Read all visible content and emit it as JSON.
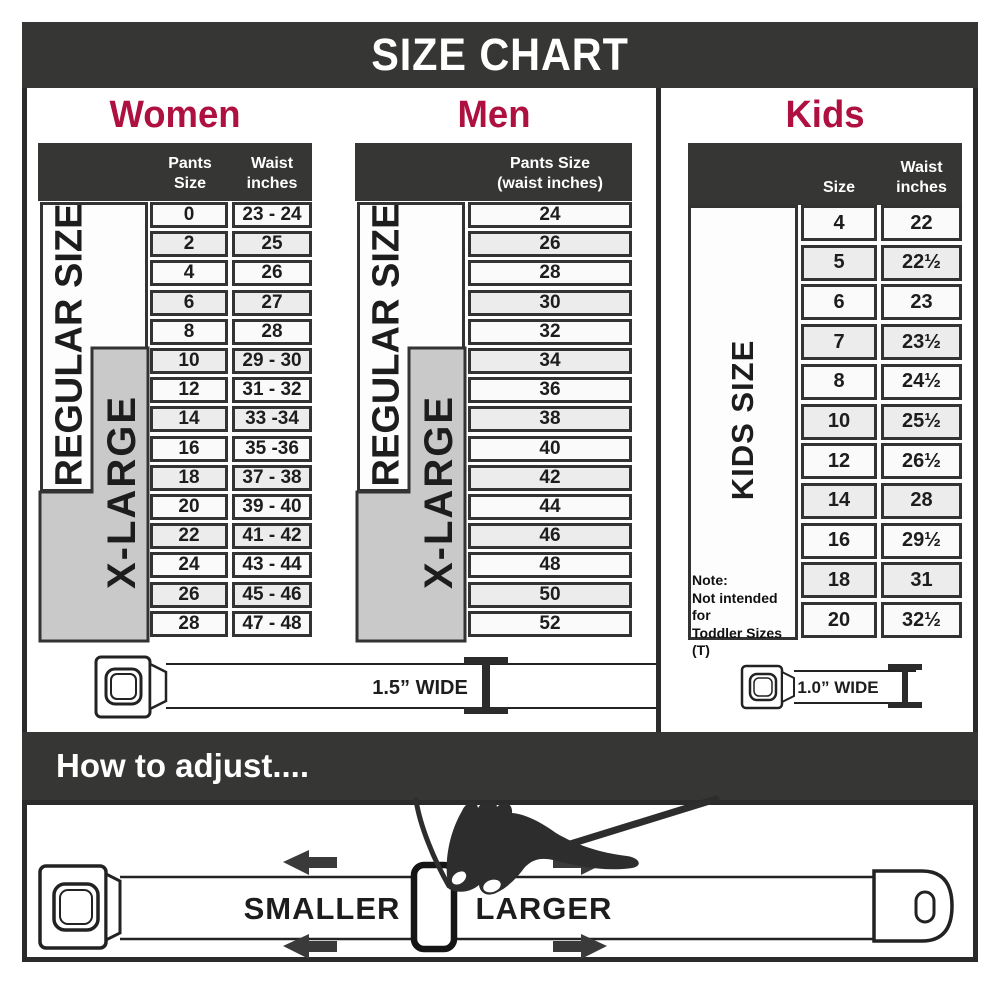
{
  "title": "SIZE CHART",
  "colors": {
    "header_bar": "#363635",
    "accent_red": "#ae1140",
    "xlarge_box_gray": "#c9c9c9",
    "row_light": "#fafafa",
    "row_alt": "#ececec",
    "ink": "#2b2b2b"
  },
  "sections": {
    "women": {
      "heading": "Women",
      "col1_header": "Pants Size",
      "col2_header_l1": "Waist",
      "col2_header_l2": "inches",
      "regular_label": "REGULAR SIZE",
      "xlarge_label": "X-LARGE"
    },
    "men": {
      "heading": "Men",
      "col_header_l1": "Pants Size",
      "col_header_l2": "(waist inches)",
      "regular_label": "REGULAR SIZE",
      "xlarge_label": "X-LARGE"
    },
    "kids": {
      "heading": "Kids",
      "col1_header": "Size",
      "col2_header_l1": "Waist",
      "col2_header_l2": "inches",
      "side_label": "KIDS SIZE",
      "note_l1": "Note:",
      "note_l2": "Not intended for",
      "note_l3": "Toddler Sizes (T)"
    }
  },
  "chart_data": [
    {
      "type": "table",
      "title": "Women",
      "columns": [
        "Pants Size",
        "Waist inches"
      ],
      "rows": [
        [
          "0",
          "23 - 24"
        ],
        [
          "2",
          "25"
        ],
        [
          "4",
          "26"
        ],
        [
          "6",
          "27"
        ],
        [
          "8",
          "28"
        ],
        [
          "10",
          "29 - 30"
        ],
        [
          "12",
          "31 - 32"
        ],
        [
          "14",
          "33 -34"
        ],
        [
          "16",
          "35 -36"
        ],
        [
          "18",
          "37 - 38"
        ],
        [
          "20",
          "39 - 40"
        ],
        [
          "22",
          "41 - 42"
        ],
        [
          "24",
          "43 - 44"
        ],
        [
          "26",
          "45 - 46"
        ],
        [
          "28",
          "47 - 48"
        ]
      ]
    },
    {
      "type": "table",
      "title": "Men",
      "columns": [
        "Pants Size (waist inches)"
      ],
      "rows": [
        [
          "24"
        ],
        [
          "26"
        ],
        [
          "28"
        ],
        [
          "30"
        ],
        [
          "32"
        ],
        [
          "34"
        ],
        [
          "36"
        ],
        [
          "38"
        ],
        [
          "40"
        ],
        [
          "42"
        ],
        [
          "44"
        ],
        [
          "46"
        ],
        [
          "48"
        ],
        [
          "50"
        ],
        [
          "52"
        ]
      ]
    },
    {
      "type": "table",
      "title": "Kids",
      "columns": [
        "Size",
        "Waist inches"
      ],
      "rows": [
        [
          "4",
          "22"
        ],
        [
          "5",
          "22½"
        ],
        [
          "6",
          "23"
        ],
        [
          "7",
          "23½"
        ],
        [
          "8",
          "24½"
        ],
        [
          "10",
          "25½"
        ],
        [
          "12",
          "26½"
        ],
        [
          "14",
          "28"
        ],
        [
          "16",
          "29½"
        ],
        [
          "18",
          "31"
        ],
        [
          "20",
          "32½"
        ]
      ]
    }
  ],
  "belts": {
    "adult_width_label": "1.5” WIDE",
    "kids_width_label": "1.0” WIDE"
  },
  "adjust": {
    "heading": "How to adjust....",
    "smaller_label": "SMALLER",
    "larger_label": "LARGER"
  }
}
